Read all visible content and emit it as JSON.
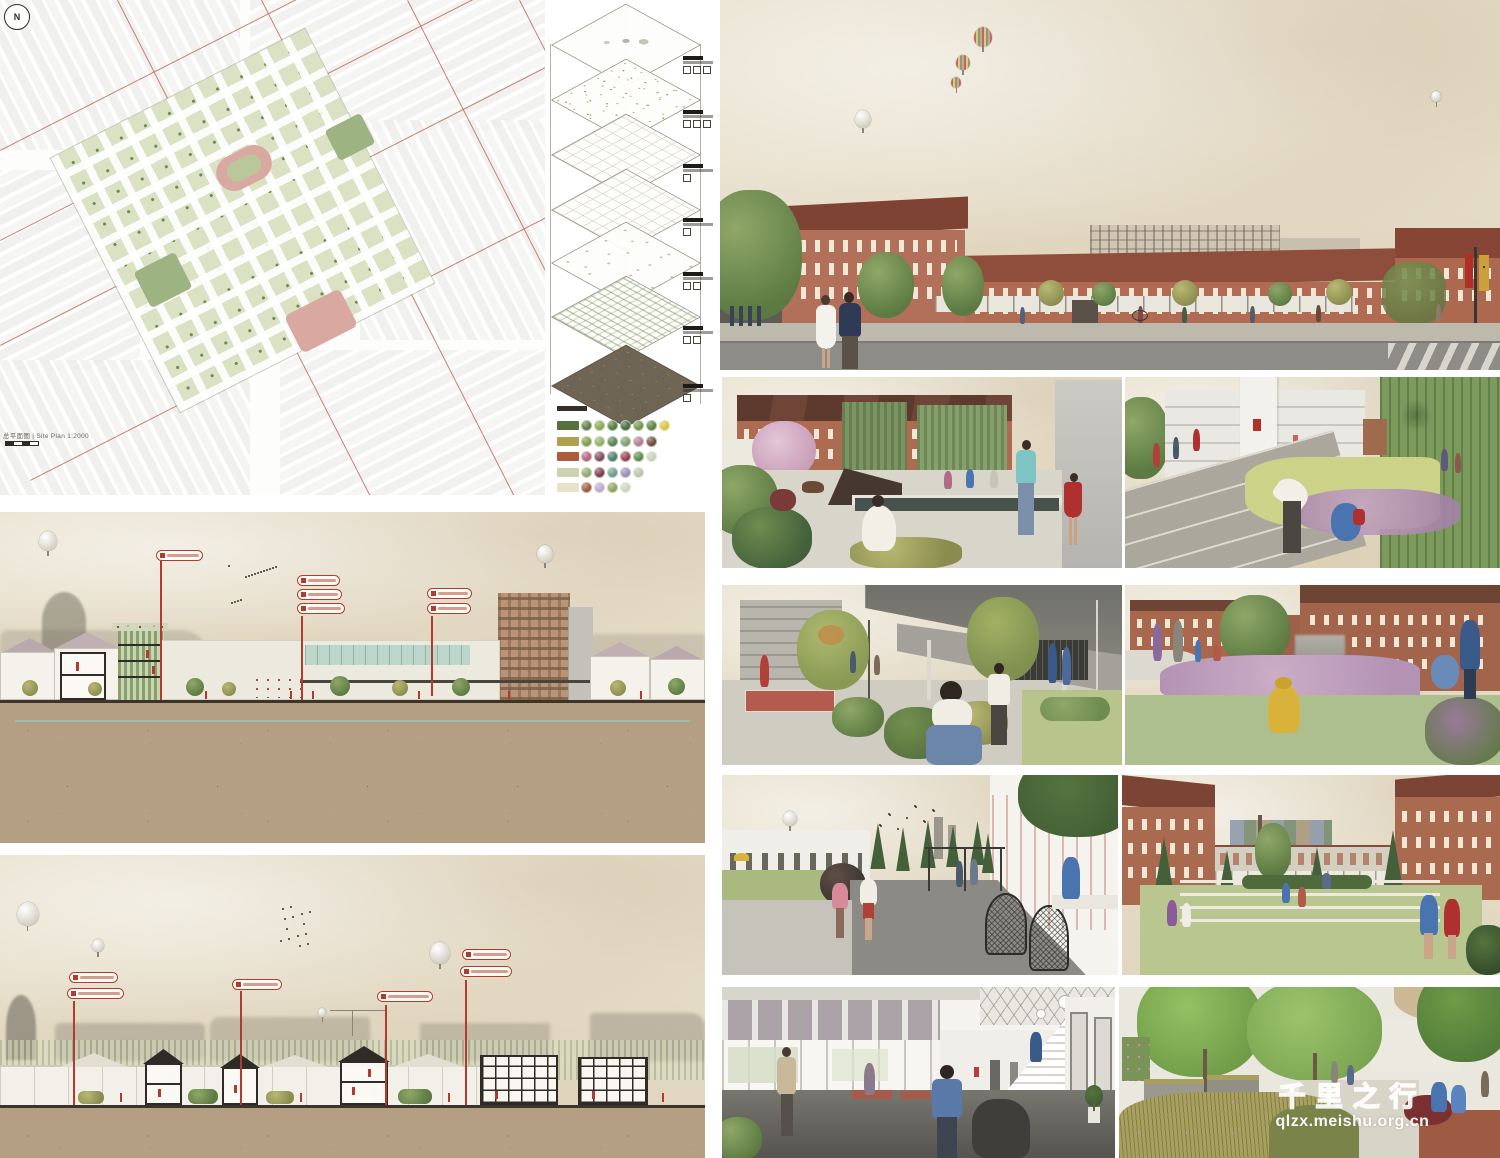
{
  "site_plan": {
    "north_label": "N",
    "caption": "总平面图 | Site Plan 1:2000"
  },
  "axon": {
    "layers": [
      {
        "cy": 44,
        "style": "model"
      },
      {
        "cy": 99,
        "style": "speckle"
      },
      {
        "cy": 154,
        "style": "lines"
      },
      {
        "cy": 209,
        "style": "lines"
      },
      {
        "cy": 262,
        "style": "blobs"
      },
      {
        "cy": 316,
        "style": "grid"
      },
      {
        "cy": 385,
        "style": "dark"
      }
    ],
    "labels": [
      {
        "y": 56,
        "icons": 3
      },
      {
        "y": 110,
        "icons": 3
      },
      {
        "y": 164,
        "icons": 1
      },
      {
        "y": 218,
        "icons": 1
      },
      {
        "y": 272,
        "icons": 2
      },
      {
        "y": 326,
        "icons": 2
      },
      {
        "y": 384,
        "icons": 1
      }
    ]
  },
  "legend": {
    "rows": [
      {
        "swatch": "#55713f",
        "circles": [
          "#5a7a3f",
          "#86a64c",
          "#4e7a3a",
          "#3f6a35",
          "#6f9448",
          "#577f3b",
          "#d9c23f"
        ]
      },
      {
        "swatch": "#b0a14e",
        "circles": [
          "#7a9a4a",
          "#8fae5f",
          "#55804a",
          "#7f9a6a",
          "#b07a8a",
          "#6a4a3a"
        ]
      },
      {
        "swatch": "#b05c3a",
        "circles": [
          "#b0607a",
          "#7a4a5a",
          "#4a7a6a",
          "#9a3a4a",
          "#5a8a4a",
          "#c8d0b8"
        ]
      },
      {
        "swatch": "#cdd2b2",
        "circles": [
          "#8aa86a",
          "#7a3a4a",
          "#6a9a8a",
          "#9a8ab0",
          "#b8c4a8"
        ]
      },
      {
        "swatch": "#e8e2cc",
        "circles": [
          "#9a5a3a",
          "#b8a8c8",
          "#8aa05a",
          "#c8d4b8"
        ]
      }
    ]
  },
  "annotations": {
    "secA": {
      "tags": [
        [
          156,
          38,
          47
        ],
        [
          297,
          63,
          43
        ],
        [
          297,
          77,
          45
        ],
        [
          297,
          91,
          48
        ],
        [
          427,
          76,
          45
        ],
        [
          427,
          91,
          44
        ]
      ],
      "stems": [
        [
          160,
          49,
          188
        ],
        [
          301,
          104,
          188
        ],
        [
          431,
          104,
          184
        ]
      ]
    },
    "secB": {
      "tags": [
        [
          69,
          117,
          49
        ],
        [
          67,
          133,
          57
        ],
        [
          232,
          124,
          50
        ],
        [
          377,
          136,
          56
        ],
        [
          462,
          94,
          49
        ],
        [
          460,
          111,
          52
        ]
      ],
      "stems": [
        [
          73,
          146,
          250
        ],
        [
          240,
          136,
          250
        ],
        [
          385,
          150,
          250
        ],
        [
          465,
          125,
          250
        ]
      ]
    }
  },
  "figures": {
    "balloons": [
      {
        "panel": "secA",
        "x": 48,
        "y": 28,
        "r": 9,
        "style": "white"
      },
      {
        "panel": "secA",
        "x": 545,
        "y": 41,
        "r": 8,
        "style": "white"
      },
      {
        "panel": "secB",
        "x": 28,
        "y": 58,
        "r": 11,
        "style": "white"
      },
      {
        "panel": "secB",
        "x": 98,
        "y": 90,
        "r": 6,
        "style": "white"
      },
      {
        "panel": "secB",
        "x": 440,
        "y": 97,
        "r": 10,
        "style": "white"
      },
      {
        "panel": "secB",
        "x": 322,
        "y": 157,
        "r": 4,
        "style": "white"
      },
      {
        "panel": "r1",
        "x": 143,
        "y": 118,
        "r": 8,
        "style": "white"
      },
      {
        "panel": "r1",
        "x": 263,
        "y": 36,
        "r": 9,
        "style": "striped"
      },
      {
        "panel": "r1",
        "x": 243,
        "y": 62,
        "r": 7,
        "style": "striped"
      },
      {
        "panel": "r1",
        "x": 236,
        "y": 82,
        "r": 5,
        "style": "striped"
      },
      {
        "panel": "r1",
        "x": 716,
        "y": 96,
        "r": 5,
        "style": "white"
      },
      {
        "panel": "r4l",
        "x": 68,
        "y": 43,
        "r": 7,
        "style": "white"
      }
    ],
    "bird_flocks": [
      {
        "panel": "secA",
        "x": 228,
        "y": 53,
        "w": 50,
        "h": 38,
        "n": 16
      },
      {
        "panel": "secB",
        "x": 275,
        "y": 50,
        "w": 36,
        "h": 42,
        "n": 14
      },
      {
        "panel": "r4l",
        "x": 150,
        "y": 28,
        "w": 62,
        "h": 26,
        "n": 12
      }
    ]
  },
  "watermark": {
    "line1": "千里之行",
    "line2": "qlzx.meishu.org.cn",
    "color": "#ffffff"
  },
  "palette": {
    "paper_sky": "#e6ddc8",
    "soil": "#b49f83",
    "brick": "#b2705a",
    "roof": "#8f4e3c",
    "accent_red": "#b23b30",
    "groundwater_teal": "#9cc0ba",
    "foliage_green": "#6f8c50",
    "masterplan_green": "#dbe2c4",
    "track_pink": "#d9a8a0"
  }
}
